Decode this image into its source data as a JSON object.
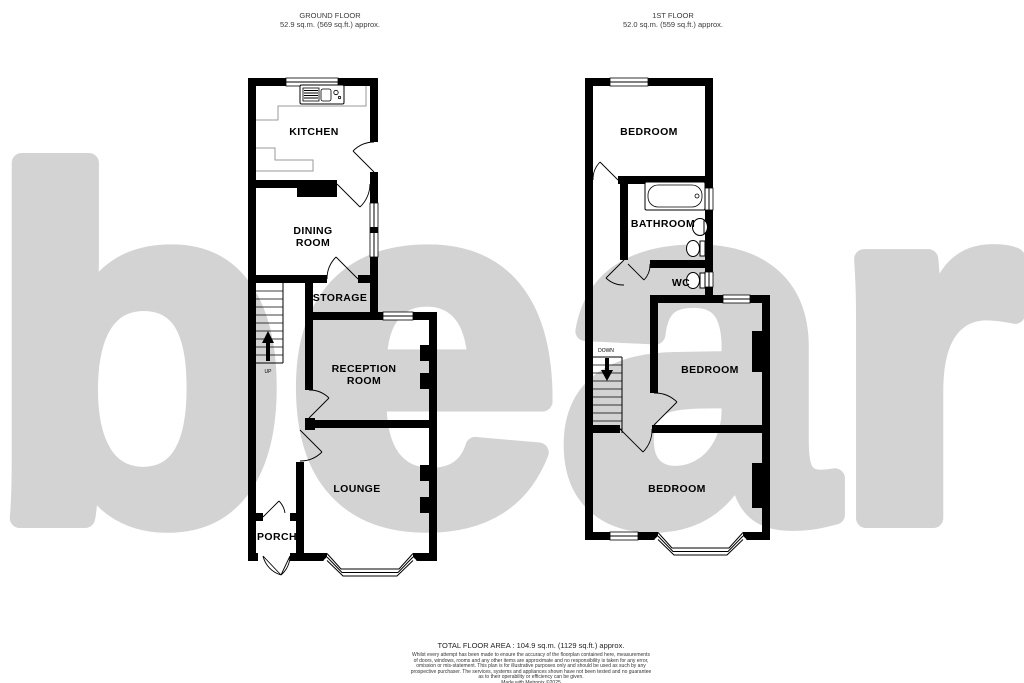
{
  "watermark": {
    "text": "bear",
    "color": "#d3d3d3"
  },
  "ground_floor": {
    "title": "GROUND FLOOR",
    "area": "52.9 sq.m. (569 sq.ft.) approx.",
    "rooms": {
      "kitchen": "KITCHEN",
      "dining1": "DINING",
      "dining2": "ROOM",
      "storage": "STORAGE",
      "reception1": "RECEPTION",
      "reception2": "ROOM",
      "lounge": "LOUNGE",
      "porch": "PORCH"
    },
    "stair_label": "UP"
  },
  "first_floor": {
    "title": "1ST FLOOR",
    "area": "52.0 sq.m. (559 sq.ft.) approx.",
    "rooms": {
      "bedroom_top": "BEDROOM",
      "bathroom": "BATHROOM",
      "wc": "WC",
      "bedroom_mid": "BEDROOM",
      "bedroom_bottom": "BEDROOM"
    },
    "stair_label": "DOWN"
  },
  "footer": {
    "total": "TOTAL FLOOR AREA : 104.9 sq.m. (1129 sq.ft.) approx.",
    "disc1": "Whilst every attempt has been made to ensure the accuracy of the floorplan contained here, measurements",
    "disc2": "of doors, windows, rooms and any other items are approximate and no responsibility is taken for any error,",
    "disc3": "omission or mis-statement. This plan is for illustrative purposes only and should be used as such by any",
    "disc4": "prospective purchaser. The services, systems and appliances shown have not been tested and no guarantee",
    "disc5": "as to their operability or efficiency can be given.",
    "credit": "Made with Metropix ©2025"
  }
}
